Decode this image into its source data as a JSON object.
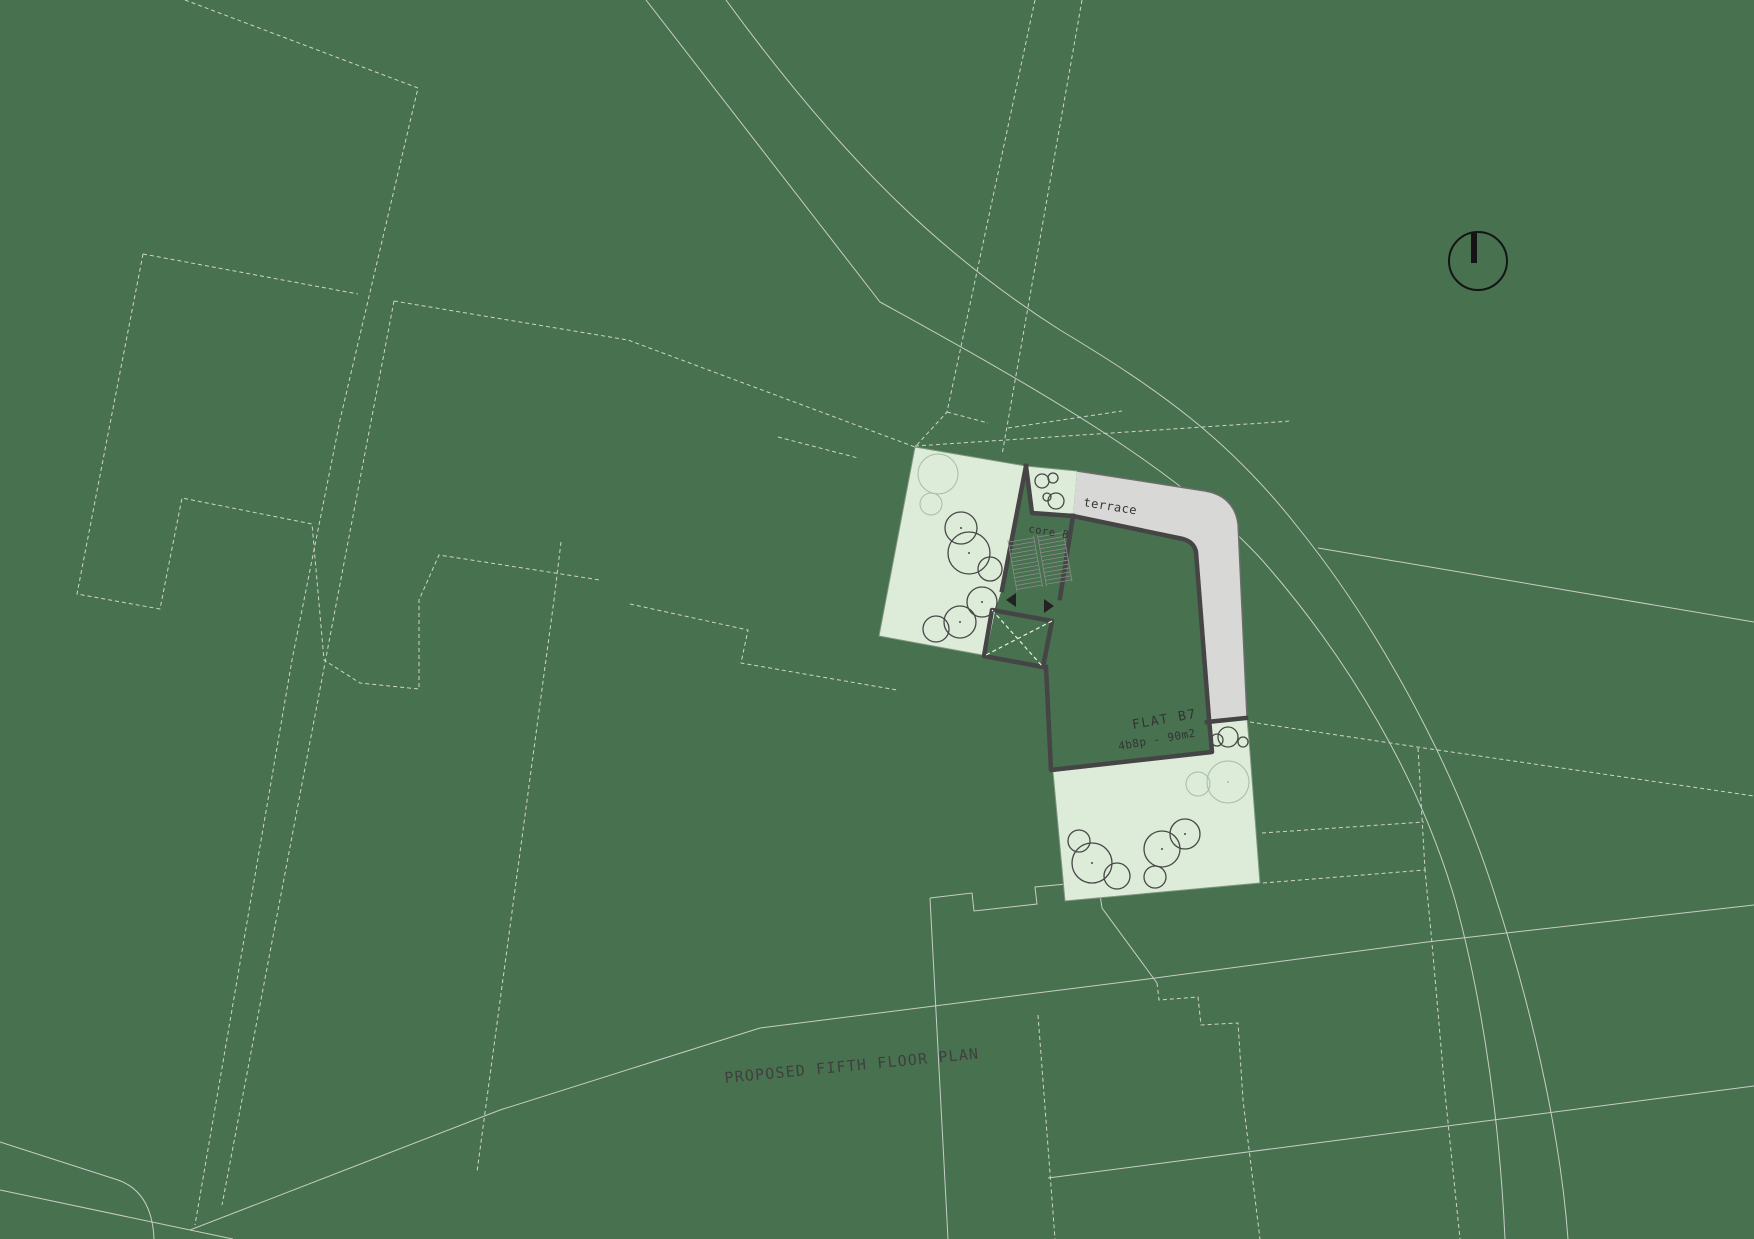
{
  "drawing": {
    "title": "PROPOSED FIFTH FLOOR PLAN"
  },
  "labels": {
    "terrace": "terrace",
    "core": "core B",
    "flat_name": "FLAT B7",
    "flat_area": "4b8p - 90m2"
  },
  "icons": {
    "north_arrow": "north-arrow-icon"
  },
  "colors": {
    "background": "#48714f",
    "context_lines": "#cdd4cb",
    "garden_fill": "#dcecd9",
    "garden_edge": "#7f957f",
    "terrace_fill": "#d8d8d6",
    "wall": "#454545",
    "tree_outline": "#474747",
    "tree_existing": "#a6bda4",
    "text": "#333333",
    "north_arrow": "#141414"
  }
}
